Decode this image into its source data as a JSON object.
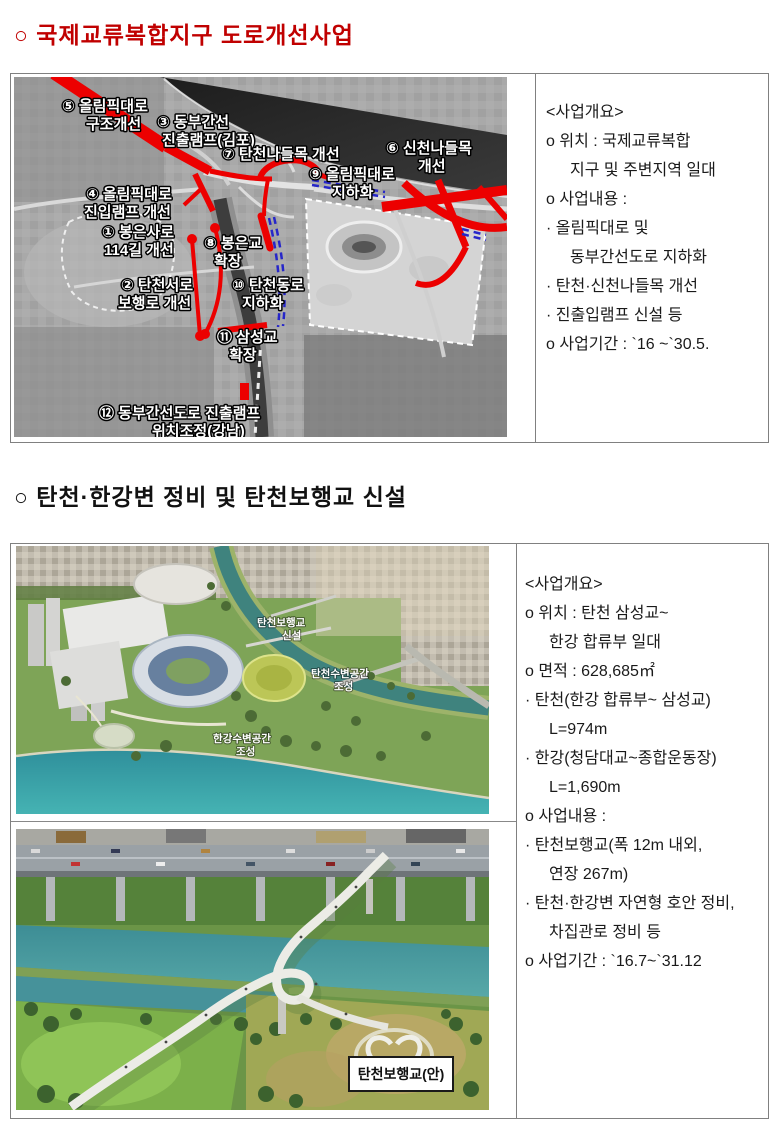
{
  "colors": {
    "title_red": "#c00000",
    "road_red": "#ec0000",
    "underground_dash_blue": "#2626c9",
    "table_border": "#808080",
    "water_teal": "#3d8d95",
    "map_label_white": "#ffffff"
  },
  "section1": {
    "title": "○ 국제교류복합지구 도로개선사업",
    "map": {
      "labels": [
        {
          "l1": "⑤ 올림픽대로",
          "l2": "구조개선"
        },
        {
          "l1": "③ 동부간선",
          "l2": "진출램프(김포)"
        },
        {
          "l1": "⑦ 탄천나들목 개선",
          "l2": ""
        },
        {
          "l1": "⑥ 신천나들목",
          "l2": "개선"
        },
        {
          "l1": "⑨ 올림픽대로",
          "l2": "지하화"
        },
        {
          "l1": "④ 올림픽대로",
          "l2": "진입램프 개선"
        },
        {
          "l1": "① 봉은사로",
          "l2": "114길 개선"
        },
        {
          "l1": "⑧ 봉은교",
          "l2": "확장"
        },
        {
          "l1": "② 탄천서로",
          "l2": "보행로 개선"
        },
        {
          "l1": "⑩ 탄천동로",
          "l2": "지하화"
        },
        {
          "l1": "⑪ 삼성교",
          "l2": "확장"
        },
        {
          "l1": "⑫ 동부간선도로 진출램프",
          "l2": "위치조정(강남)"
        }
      ]
    },
    "overview": {
      "heading": "<사업개요>",
      "lines": [
        "o 위치 : 국제교류복합",
        "지구 및 주변지역 일대",
        "o 사업내용 :",
        "· 올림픽대로 및",
        "동부간선도로 지하화",
        "· 탄천·신천나들목 개선",
        "· 진출입램프 신설 등",
        "o 사업기간 : `16 ~`30.5."
      ]
    }
  },
  "section2": {
    "title": "○ 탄천·한강변 정비 및 탄천보행교 신설",
    "aerial_labels": [
      {
        "l1": "탄천보행교",
        "l2": "신설"
      },
      {
        "l1": "탄천수변공간",
        "l2": "조성"
      },
      {
        "l1": "한강수변공간",
        "l2": "조성"
      }
    ],
    "bridge_caption": "탄천보행교(안)",
    "overview": {
      "heading": "<사업개요>",
      "lines": [
        "o 위치 : 탄천 삼성교~",
        "한강 합류부 일대",
        "o 면적 : 628,685㎡",
        "· 탄천(한강 합류부~ 삼성교)",
        "L=974m",
        "· 한강(청담대교~종합운동장)",
        "L=1,690m",
        "o 사업내용 :",
        "· 탄천보행교(폭 12m 내외,",
        "연장 267m)",
        "· 탄천·한강변 자연형 호안 정비,",
        "차집관로 정비 등",
        "o 사업기간 : `16.7~`31.12"
      ]
    }
  }
}
